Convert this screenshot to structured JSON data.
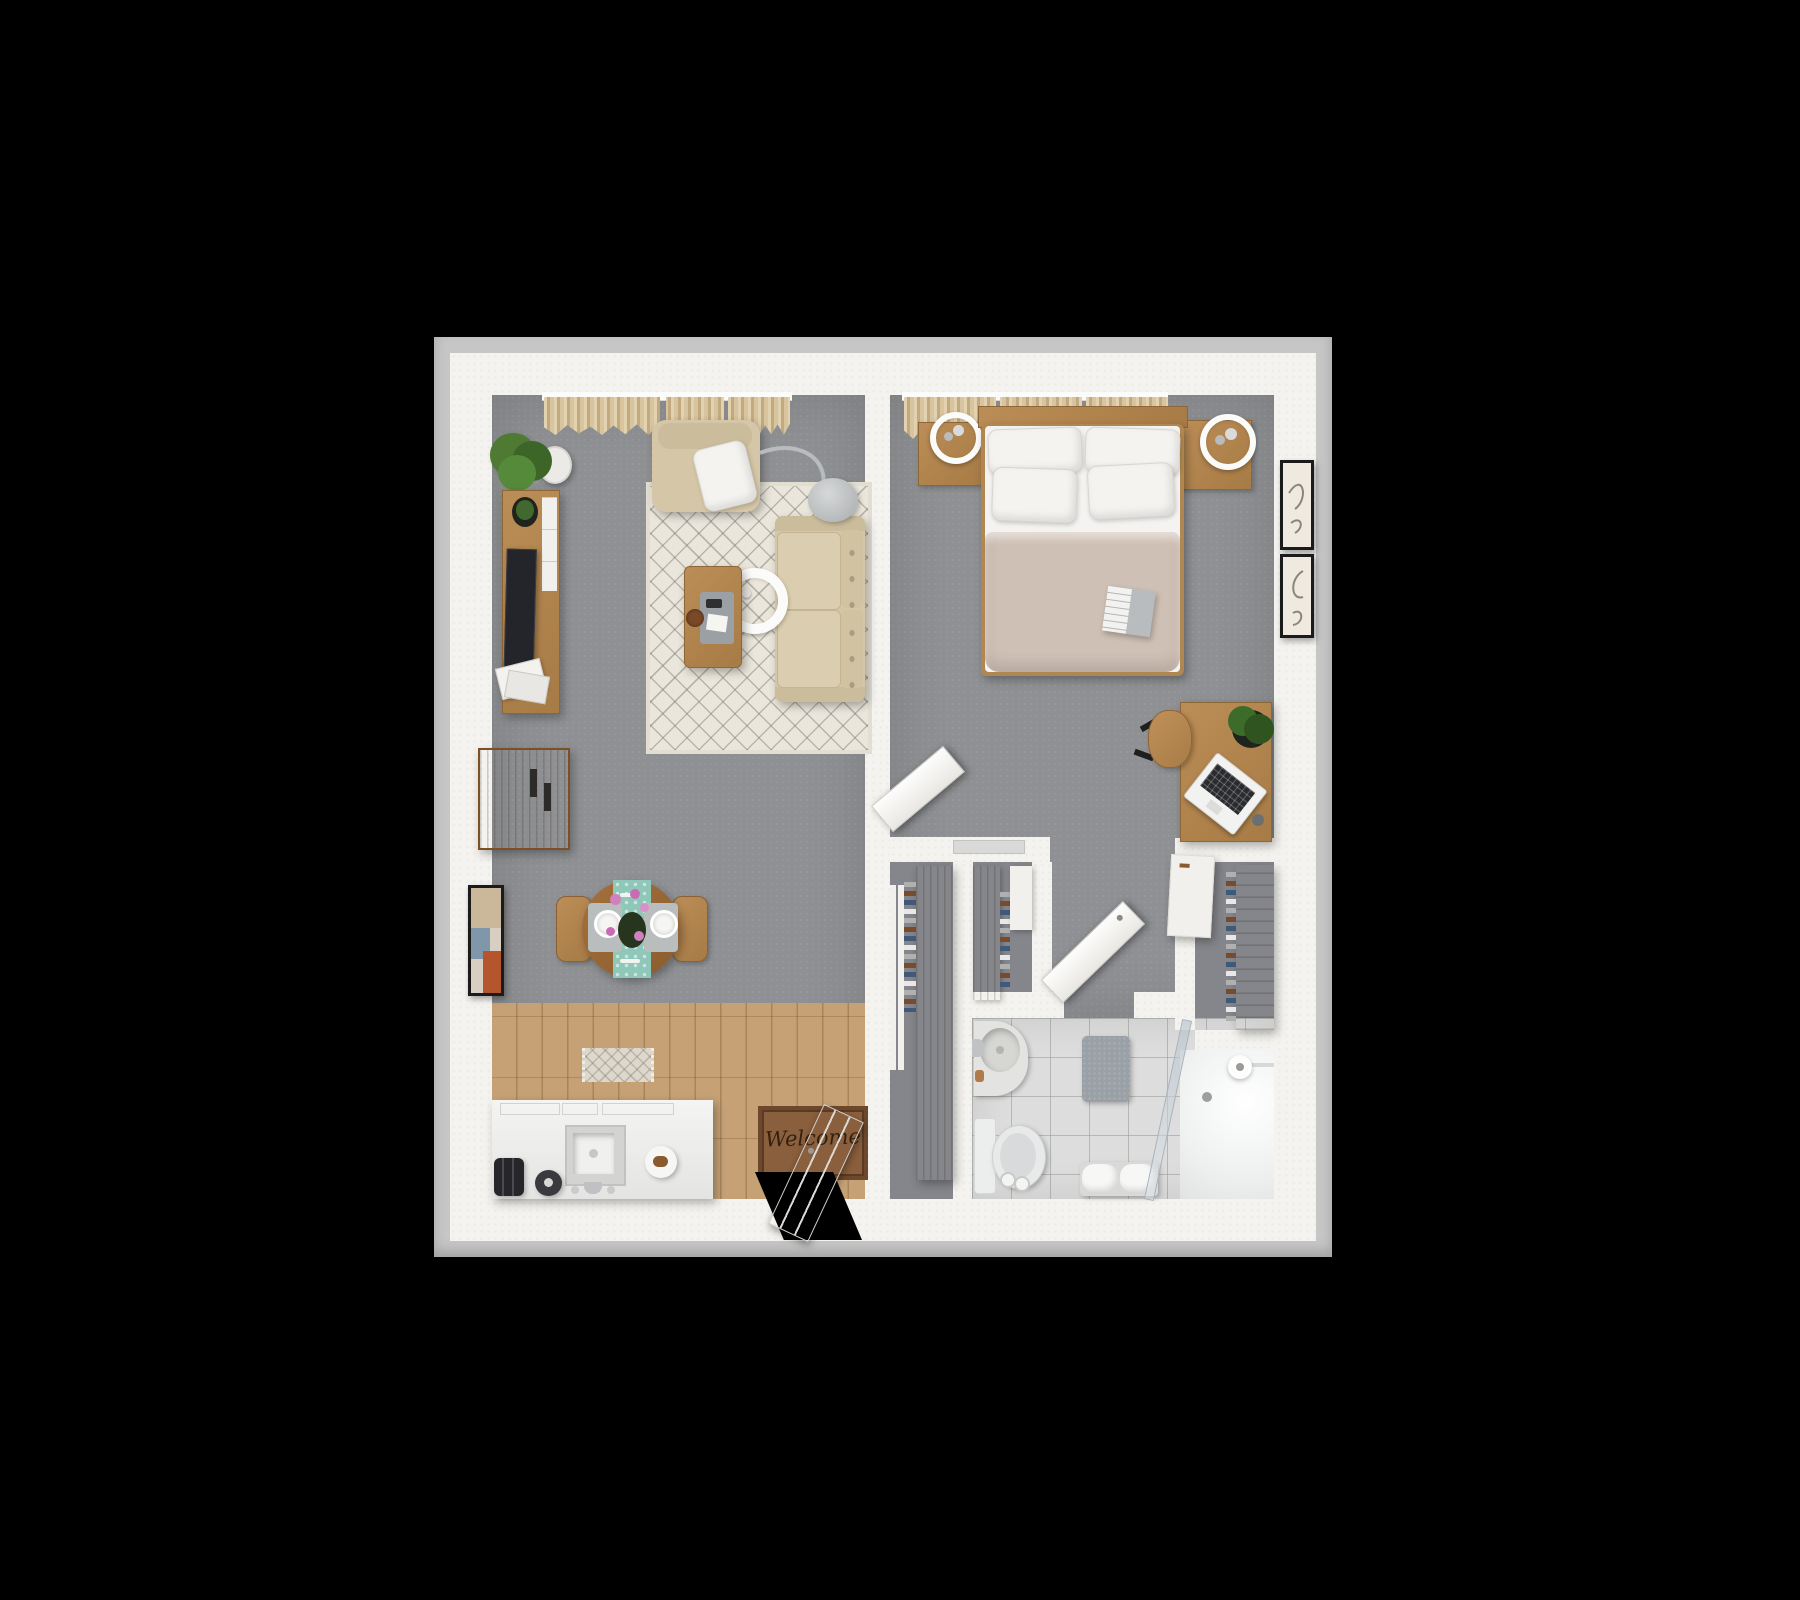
{
  "scene": {
    "type": "3d-top-down-floor-plan-render",
    "description": "One-bedroom apartment floor plan, bird's-eye 3D render on black background",
    "background_color": "#000000",
    "welcome_mat_text": "Welcome"
  },
  "palette": {
    "outer_rim": "#c6c6c6",
    "walls": "#f4f3ef",
    "carpet_gray": "#8e9093",
    "wood_floor": "#c19a6b",
    "furniture_wood": "#b08751",
    "sofa_beige": "#d5c6a7",
    "duvet_taupe": "#cfc0b5",
    "bathroom_tile": "#dcdddc",
    "table_runner_teal": "#8fc7b9",
    "doormat_brown": "#8a5f3d"
  },
  "rooms": {
    "living_room": {
      "floor": "gray carpet",
      "items": [
        "window curtains",
        "potted plant",
        "tv-console with tv, plant and magazines",
        "bar cabinet",
        "wall art frame",
        "area rug",
        "armchair with throw pillow",
        "sofa",
        "arc floor lamp",
        "ring pendant lamp",
        "coffee table with tray, remote and coaster",
        "round dining table for two",
        "teal table runner",
        "pink flowers",
        "two wooden chairs"
      ]
    },
    "kitchen": {
      "floor": "wood planks",
      "items": [
        "kitchen island with cooktop and sink",
        "faucet",
        "toaster",
        "kettle",
        "plate with croissant",
        "small patterned rug",
        "welcome doormat",
        "entry door (open)"
      ]
    },
    "bedroom": {
      "floor": "gray carpet",
      "items": [
        "window curtains",
        "double bed with 4 pillows and taupe duvet",
        "magazine on bed",
        "left nightstand with ring lamp",
        "right nightstand with ring lamp",
        "desk with laptop, plant and coaster",
        "desk chair",
        "white dresser",
        "two framed art prints",
        "bedroom door (open)"
      ]
    },
    "bathroom": {
      "floor": "gray tiles",
      "items": [
        "round sink with faucet and soap",
        "toilet",
        "toilet paper stand",
        "gray bath mat",
        "towel bench",
        "walk-in shower with glass panel",
        "shower head",
        "floor drain",
        "bathroom door (open)"
      ]
    },
    "closets": {
      "items": [
        "hallway wardrobe with hanging clothes",
        "sliding panels",
        "second wardrobe with shelves",
        "white storage box",
        "shoe and clothes shelf"
      ]
    },
    "entry": {
      "items": [
        "doorway opening",
        "welcome doormat"
      ]
    }
  }
}
